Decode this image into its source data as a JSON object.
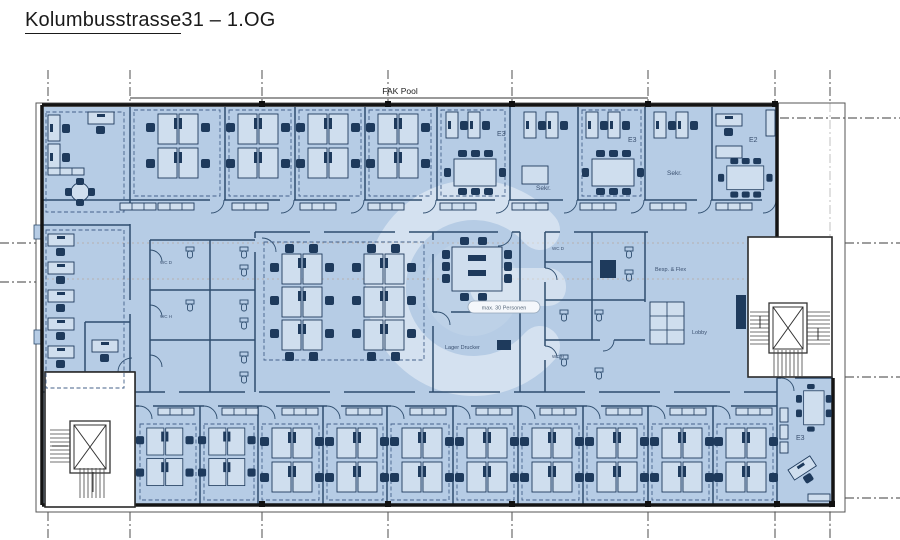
{
  "title": {
    "part1": "Kolumbusstrasse",
    "part2": " 31 – 1.OG"
  },
  "plan": {
    "pool_label": "FAK Pool",
    "rooms": {
      "e3_a": "E3",
      "sekr_a": "Sekr.",
      "e3_b": "E3",
      "sekr_b": "Sekr.",
      "e2": "E2",
      "bespr": "Besp. & Flex",
      "lobby": "Lobby",
      "lager": "Lager Drucker",
      "capacity": "max. 30 Personen",
      "wc_d_left": "WC D",
      "wc_h_left": "WC H",
      "wc_d_right": "WC D",
      "wc_h_right": "WC H",
      "e3_c": "E3"
    },
    "colors": {
      "floor": "#b6cce5",
      "furniture": "#1e3a5c",
      "exterior_wall": "#141414",
      "interior_wall": "#2e4d6e",
      "title_underline_wave": "#e03a2f"
    }
  }
}
